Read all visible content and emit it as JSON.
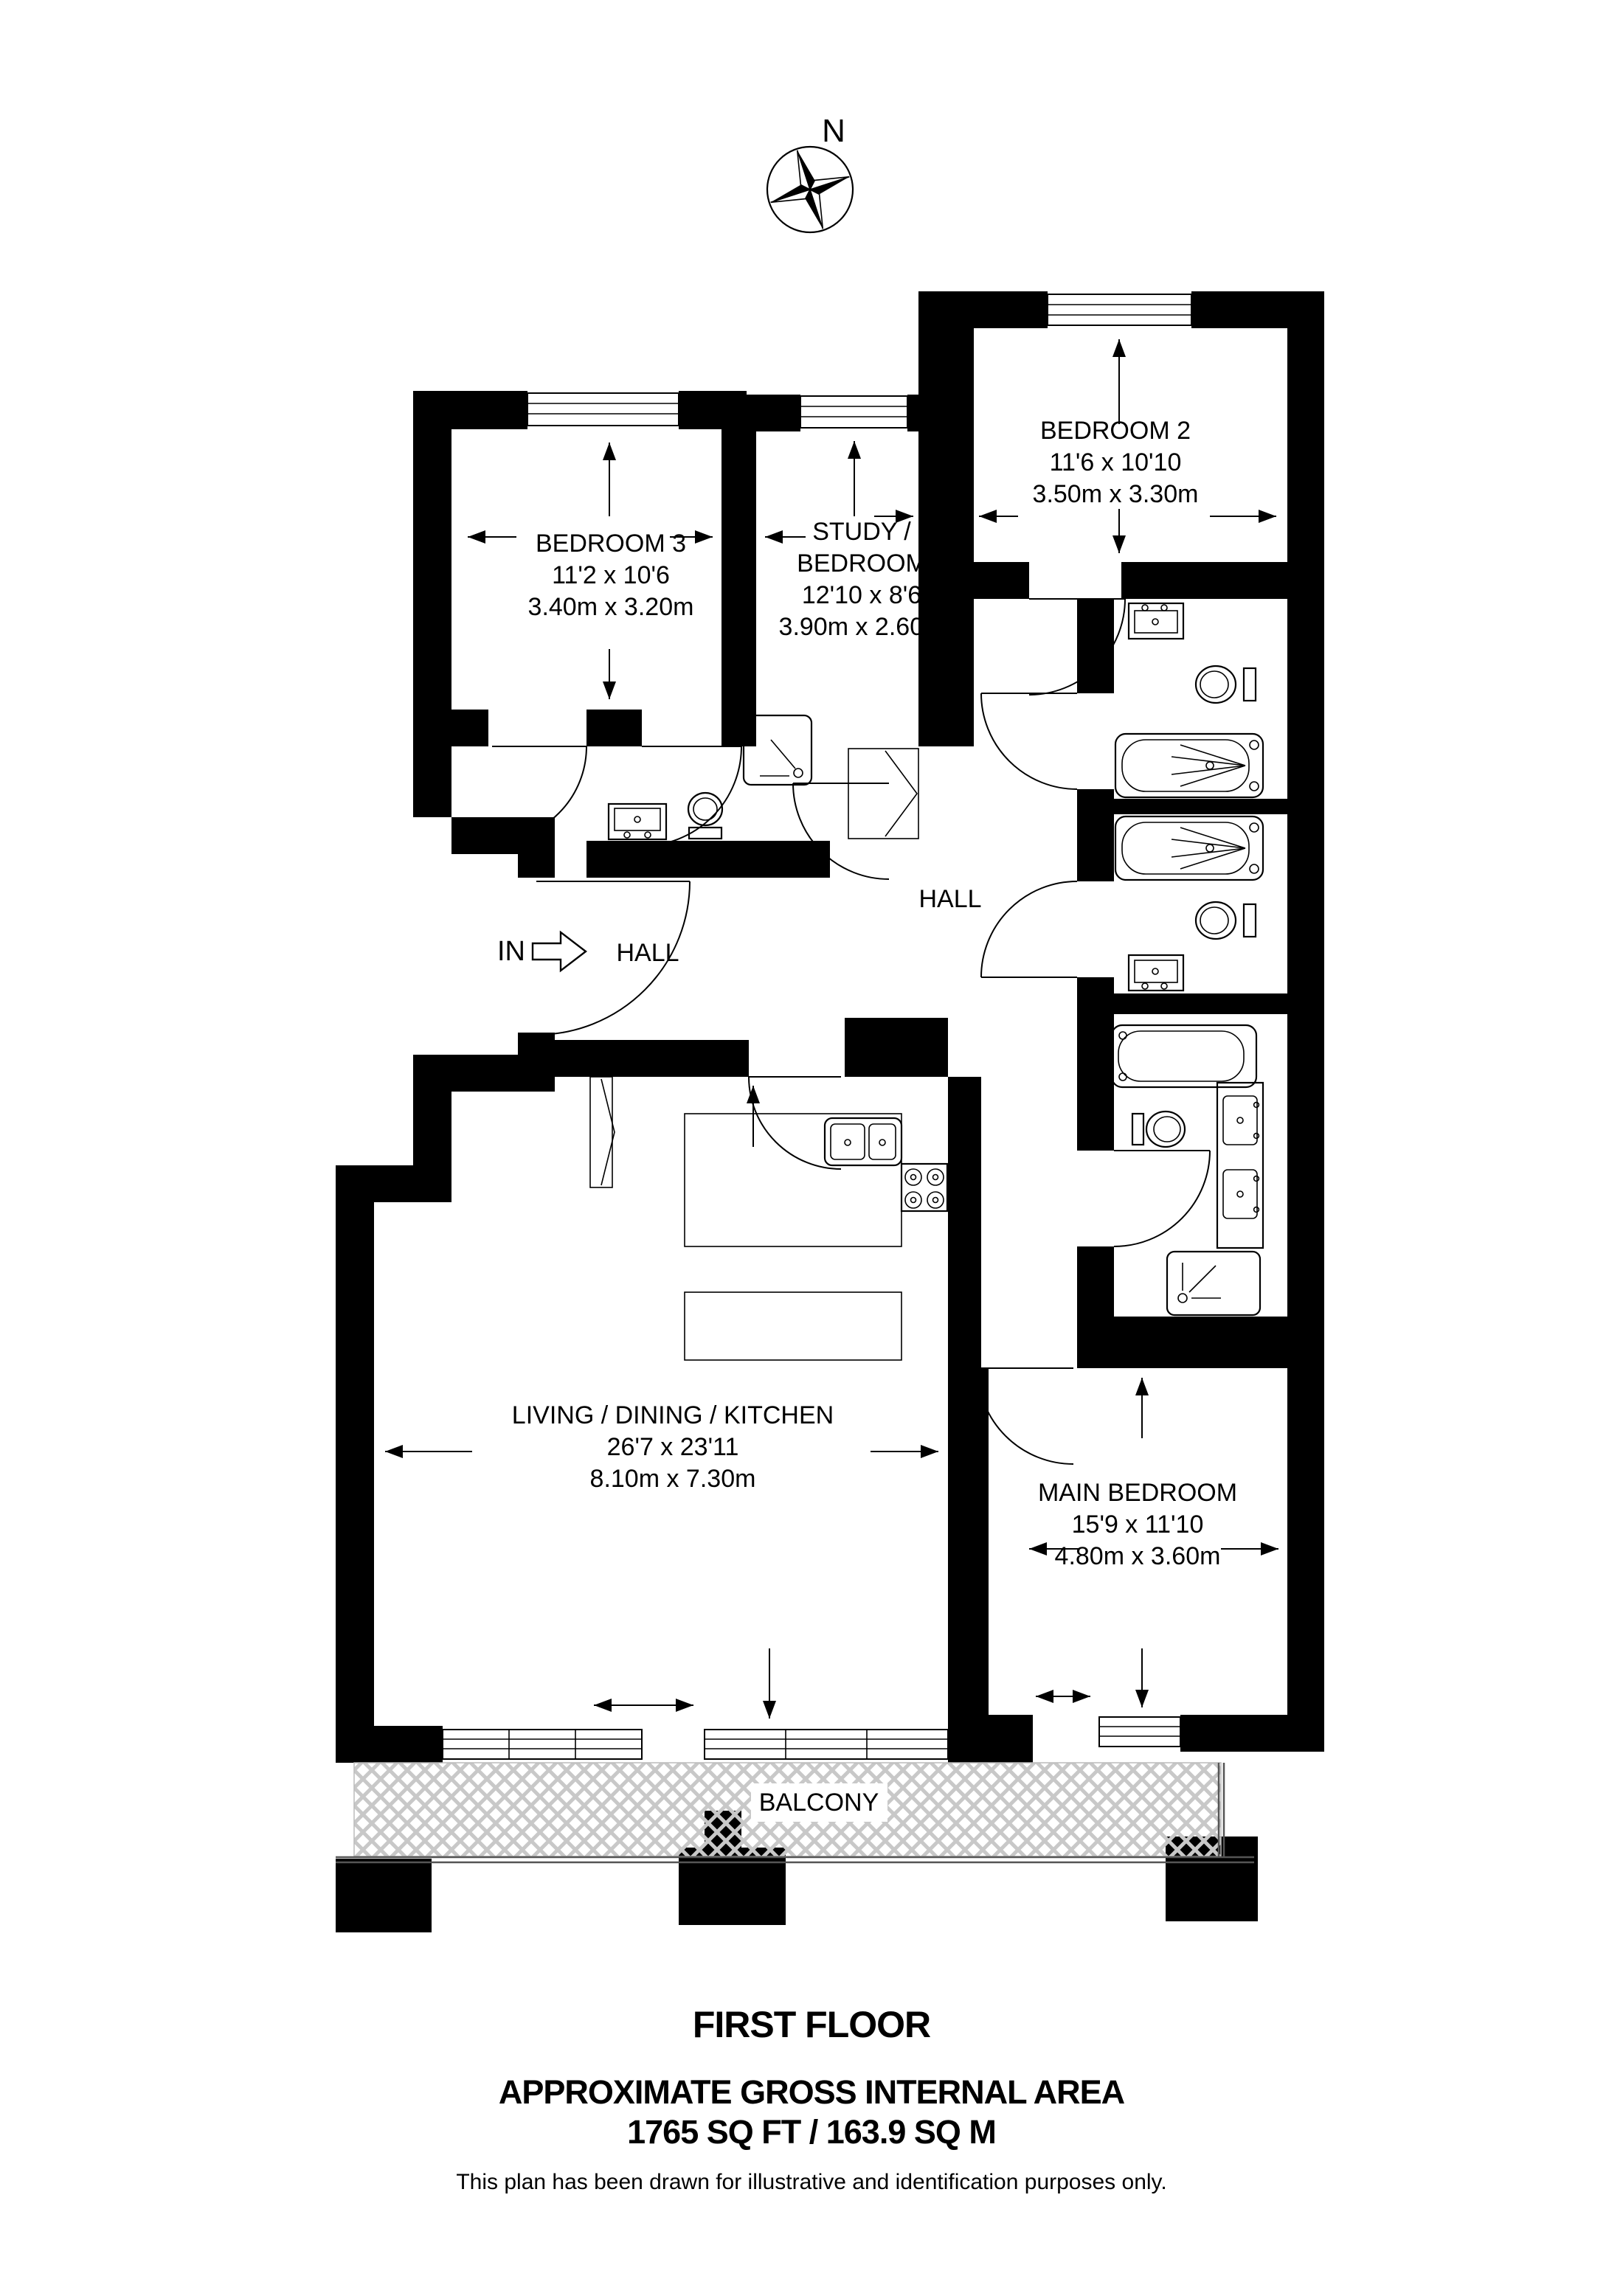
{
  "title_block": {
    "floor": "FIRST FLOOR",
    "area_heading": "APPROXIMATE GROSS INTERNAL AREA",
    "area_value": "1765 SQ FT / 163.9 SQ M",
    "disclaimer": "This plan has been drawn for illustrative and identification purposes only."
  },
  "compass": {
    "north_label": "N"
  },
  "entrance": {
    "label": "IN"
  },
  "rooms": {
    "bedroom2": {
      "name": "BEDROOM 2",
      "imperial": "11'6 x 10'10",
      "metric": "3.50m x 3.30m"
    },
    "bedroom3": {
      "name": "BEDROOM 3",
      "imperial": "11'2 x 10'6",
      "metric": "3.40m x 3.20m"
    },
    "study": {
      "name_line1": "STUDY /",
      "name_line2": "BEDROOM",
      "imperial": "12'10 x 8'6",
      "metric": "3.90m x 2.60m"
    },
    "hall_left": {
      "name": "HALL"
    },
    "hall_right": {
      "name": "HALL"
    },
    "living": {
      "name": "LIVING / DINING / KITCHEN",
      "imperial": "26'7 x 23'11",
      "metric": "8.10m x 7.30m"
    },
    "main_bedroom": {
      "name": "MAIN BEDROOM",
      "imperial": "15'9 x 11'10",
      "metric": "4.80m x 3.60m"
    },
    "balcony": {
      "name": "BALCONY"
    }
  },
  "colors": {
    "walls": "#000000",
    "background": "#ffffff",
    "hatch": "#c8c8c8"
  }
}
